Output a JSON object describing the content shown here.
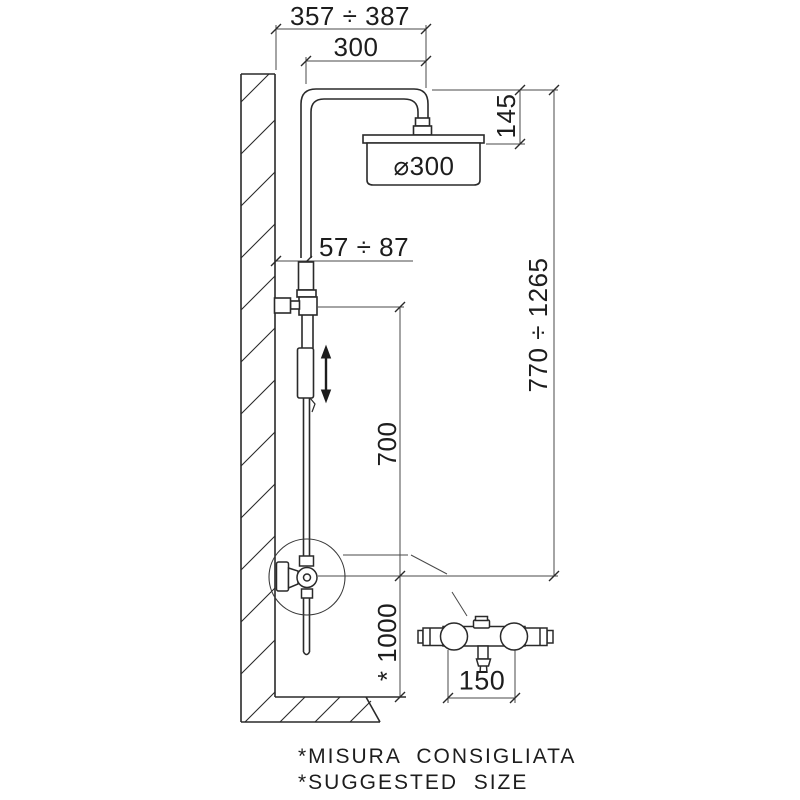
{
  "drawing": {
    "title": "shower-column-installation-diagram",
    "dimensions": {
      "wall_to_head_range": "357 ÷ 387",
      "arm_projection": "300",
      "head_drop": "145",
      "head_diameter": "⌀300",
      "wall_offset_range": "57 ÷ 87",
      "column_height_range": "770 ÷ 1265",
      "slide_travel": "700",
      "mixer_floor_height": "* 1000",
      "mixer_inlet_centers": "150"
    },
    "notes": {
      "italian": "*MISURA  CONSIGLIATA",
      "english": "*SUGGESTED  SIZE"
    },
    "colors": {
      "background": "#ffffff",
      "line": "#2a2a2a",
      "dim_line": "#4a4a4a"
    },
    "icons": {
      "adjustment_arrow": "double-headed vertical arrow"
    }
  }
}
